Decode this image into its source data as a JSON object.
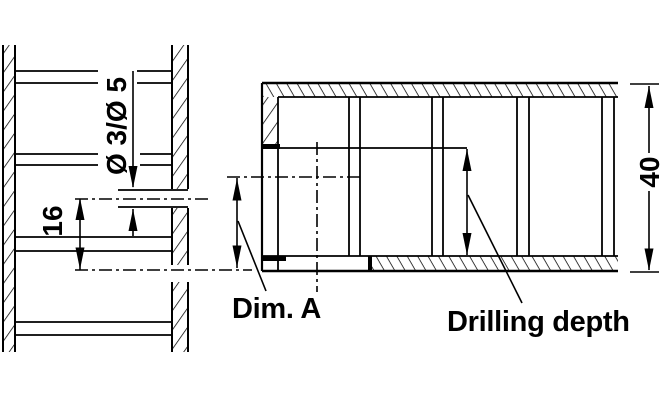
{
  "page": {
    "background": "#ffffff",
    "line_color": "#000000"
  },
  "drawing": {
    "left_view": {
      "hole_diameter_label": "Ø 3/Ø 5",
      "hole_spacing_label": "16"
    },
    "right_view": {
      "thickness_label": "40",
      "dim_a_label": "Dim. A",
      "drilling_depth_label": "Drilling depth"
    }
  }
}
